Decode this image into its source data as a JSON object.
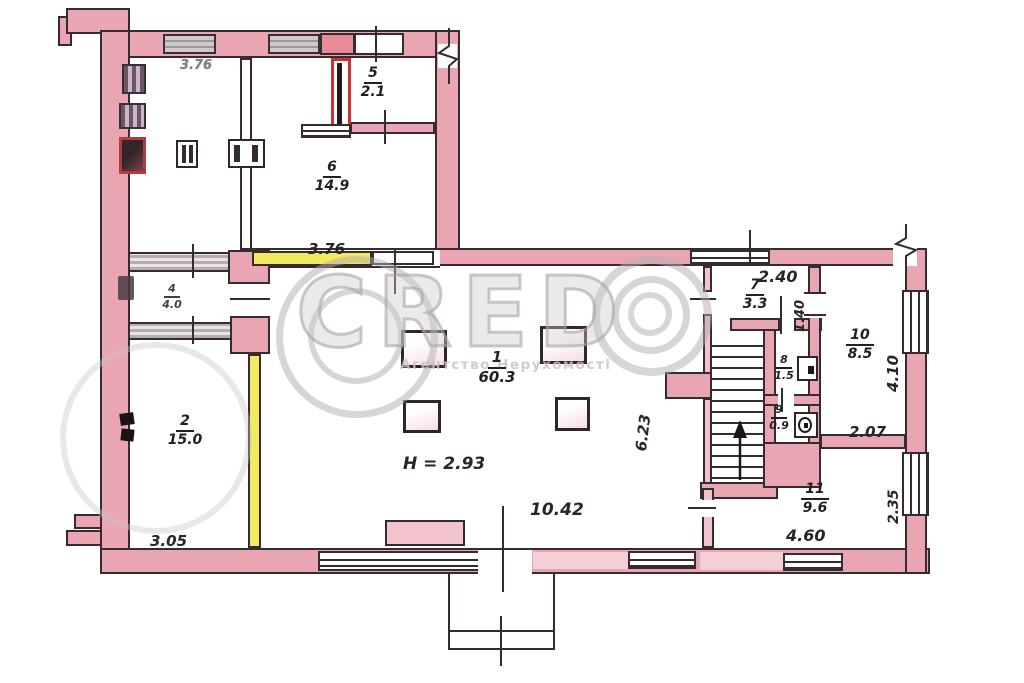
{
  "watermark": {
    "brand": "CRED",
    "subtitle": "Агентство Нерухомості"
  },
  "height_note": "H = 2.93",
  "dims": {
    "top_faint": "3.76",
    "partition": "3.76",
    "d240": "2.40",
    "d140": "1.40",
    "d410": "4.10",
    "d623": "6.23",
    "d207": "2.07",
    "d235": "2.35",
    "d1042": "10.42",
    "d460": "4.60",
    "d305": "3.05"
  },
  "rooms": {
    "r1": {
      "num": "1",
      "area": "60.3"
    },
    "r2": {
      "num": "2",
      "area": "15.0"
    },
    "r4": {
      "num": "4",
      "area": "4.0"
    },
    "r5": {
      "num": "5",
      "area": "2.1"
    },
    "r6": {
      "num": "6",
      "area": "14.9"
    },
    "r7": {
      "num": "7",
      "area": "3.3"
    },
    "r8": {
      "num": "8",
      "area": "1.5"
    },
    "r9": {
      "num": "9",
      "area": "0.9"
    },
    "r10": {
      "num": "10",
      "area": "8.5"
    },
    "r11": {
      "num": "11",
      "area": "9.6"
    }
  }
}
